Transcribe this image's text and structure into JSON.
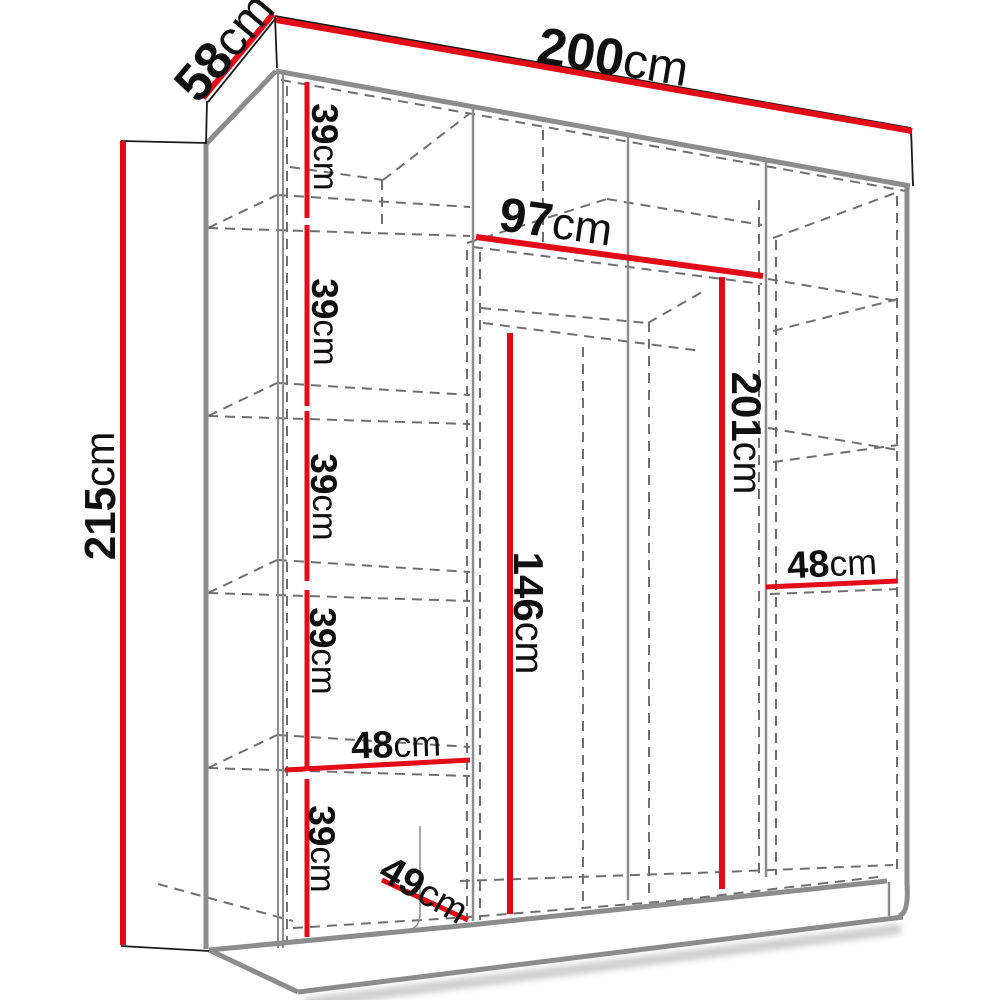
{
  "diagram": {
    "title": "wardrobe-dimension-diagram",
    "accent_color": "#e30b17",
    "structure_color": "#8c8c8c",
    "hidden_edge_color": "#6f6f6f"
  },
  "dims": {
    "width": {
      "num": "200",
      "unit": "cm"
    },
    "depth": {
      "num": "58",
      "unit": "cm"
    },
    "height": {
      "num": "215",
      "unit": "cm"
    },
    "upper_width": {
      "num": "97",
      "unit": "cm"
    },
    "interior_height": {
      "num": "201",
      "unit": "cm"
    },
    "hanging_height": {
      "num": "146",
      "unit": "cm"
    },
    "right_shelf_width": {
      "num": "48",
      "unit": "cm"
    },
    "left_shelf_width": {
      "num": "48",
      "unit": "cm"
    },
    "interior_depth": {
      "num": "49",
      "unit": "cm"
    },
    "shelf_gap_1": {
      "num": "39",
      "unit": "cm"
    },
    "shelf_gap_2": {
      "num": "39",
      "unit": "cm"
    },
    "shelf_gap_3": {
      "num": "39",
      "unit": "cm"
    },
    "shelf_gap_4": {
      "num": "39",
      "unit": "cm"
    },
    "shelf_gap_5": {
      "num": "39",
      "unit": "cm"
    }
  }
}
